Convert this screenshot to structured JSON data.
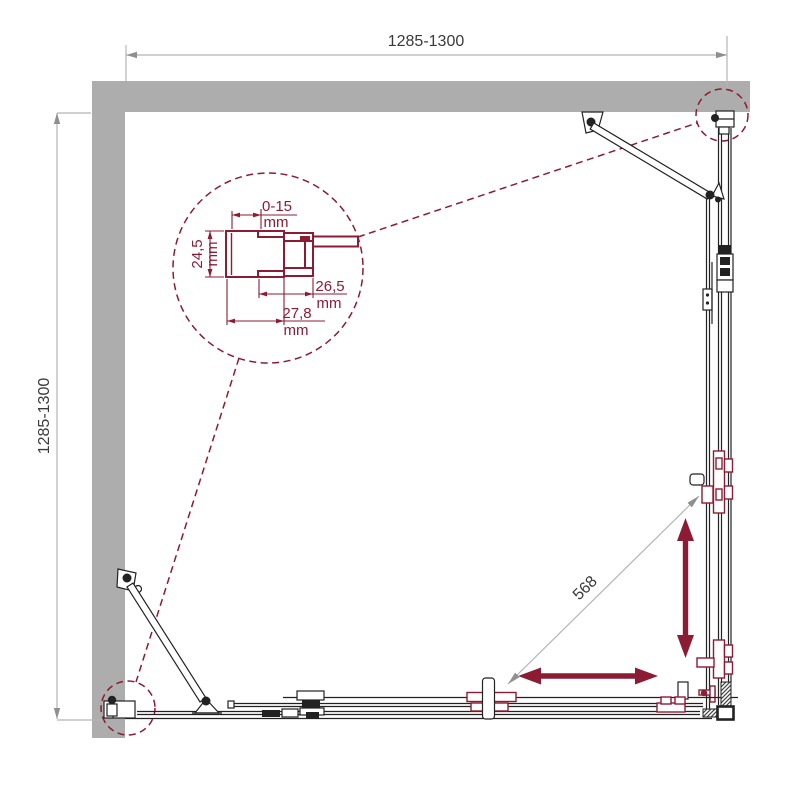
{
  "drawing": {
    "name": "corner shower enclosure dimensional plan drawing",
    "dims": {
      "top_width": "1285-1300",
      "left_height": "1285-1300",
      "entry_diagonal": "568"
    },
    "detail": {
      "adjust": "0-15",
      "adjust_unit": "mm",
      "depth": "24,5",
      "depth_unit": "mm",
      "inner": "26,5",
      "inner_unit": "mm",
      "outer": "27,8",
      "outer_unit": "mm"
    },
    "colors": {
      "wall": "#adadad",
      "accent": "#8c1c33",
      "line": "#222222",
      "dim_line": "#b5b5b5",
      "dim_arrow": "#8f8f8f",
      "text": "#3a3a3a"
    }
  }
}
